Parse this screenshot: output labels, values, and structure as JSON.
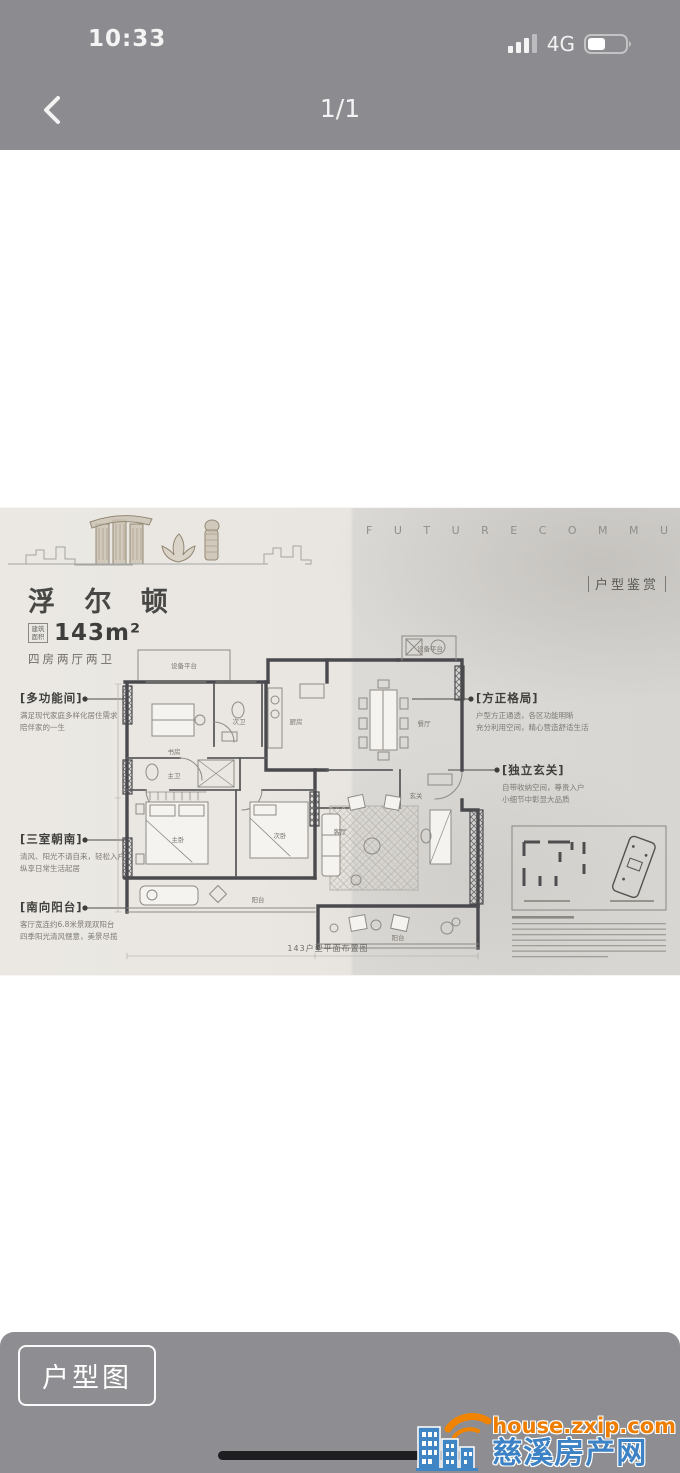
{
  "status_bar": {
    "time": "10:33",
    "network": "4G"
  },
  "nav_bar": {
    "page_indicator": "1/1"
  },
  "photo": {
    "header_en": "F U T U R E   C O M M U N I T Y",
    "section_tag": "户型鉴赏",
    "title": "浮 尔 顿",
    "area_label": "建筑面积",
    "area_value": "143m²",
    "layout_summary": "四房两厅两卫",
    "caption": "143户型平面布置图",
    "annotations": {
      "left": [
        {
          "heading": "[多功能间]",
          "line1": "满足现代家庭多样化居住需求",
          "line2": "陪伴家的一生"
        },
        {
          "heading": "[三室朝南]",
          "line1": "清风、阳光不请自来，轻松入户",
          "line2": "纵享日常生活起居"
        },
        {
          "heading": "[南向阳台]",
          "line1": "客厅宽连约6.8米景观双阳台",
          "line2": "四季阳光清风惬意，美景尽揽"
        }
      ],
      "right": [
        {
          "heading": "[方正格局]",
          "line1": "户型方正通透，各区功能明晰",
          "line2": "充分利用空间，精心营造舒适生活"
        },
        {
          "heading": "[独立玄关]",
          "line1": "自带收纳空间，尊贵入户",
          "line2": "小细节中彰显大品质"
        }
      ]
    },
    "rooms": {
      "equip1": "设备平台",
      "study": "书房",
      "bath2": "次卫",
      "kitchen": "厨房",
      "equip2": "设备平台",
      "dining": "餐厅",
      "foyer": "玄关",
      "bath1": "主卫",
      "master": "主卧",
      "bed2": "次卧",
      "living": "客厅",
      "balcony_s": "阳台",
      "balcony_se": "阳台"
    }
  },
  "bottom_bar": {
    "button_label": "户型图"
  },
  "watermark": {
    "url": "house.zxip.com",
    "site_name": "慈溪房产网",
    "url_color": "#ef7e00",
    "name_color": "#3d82c4"
  }
}
